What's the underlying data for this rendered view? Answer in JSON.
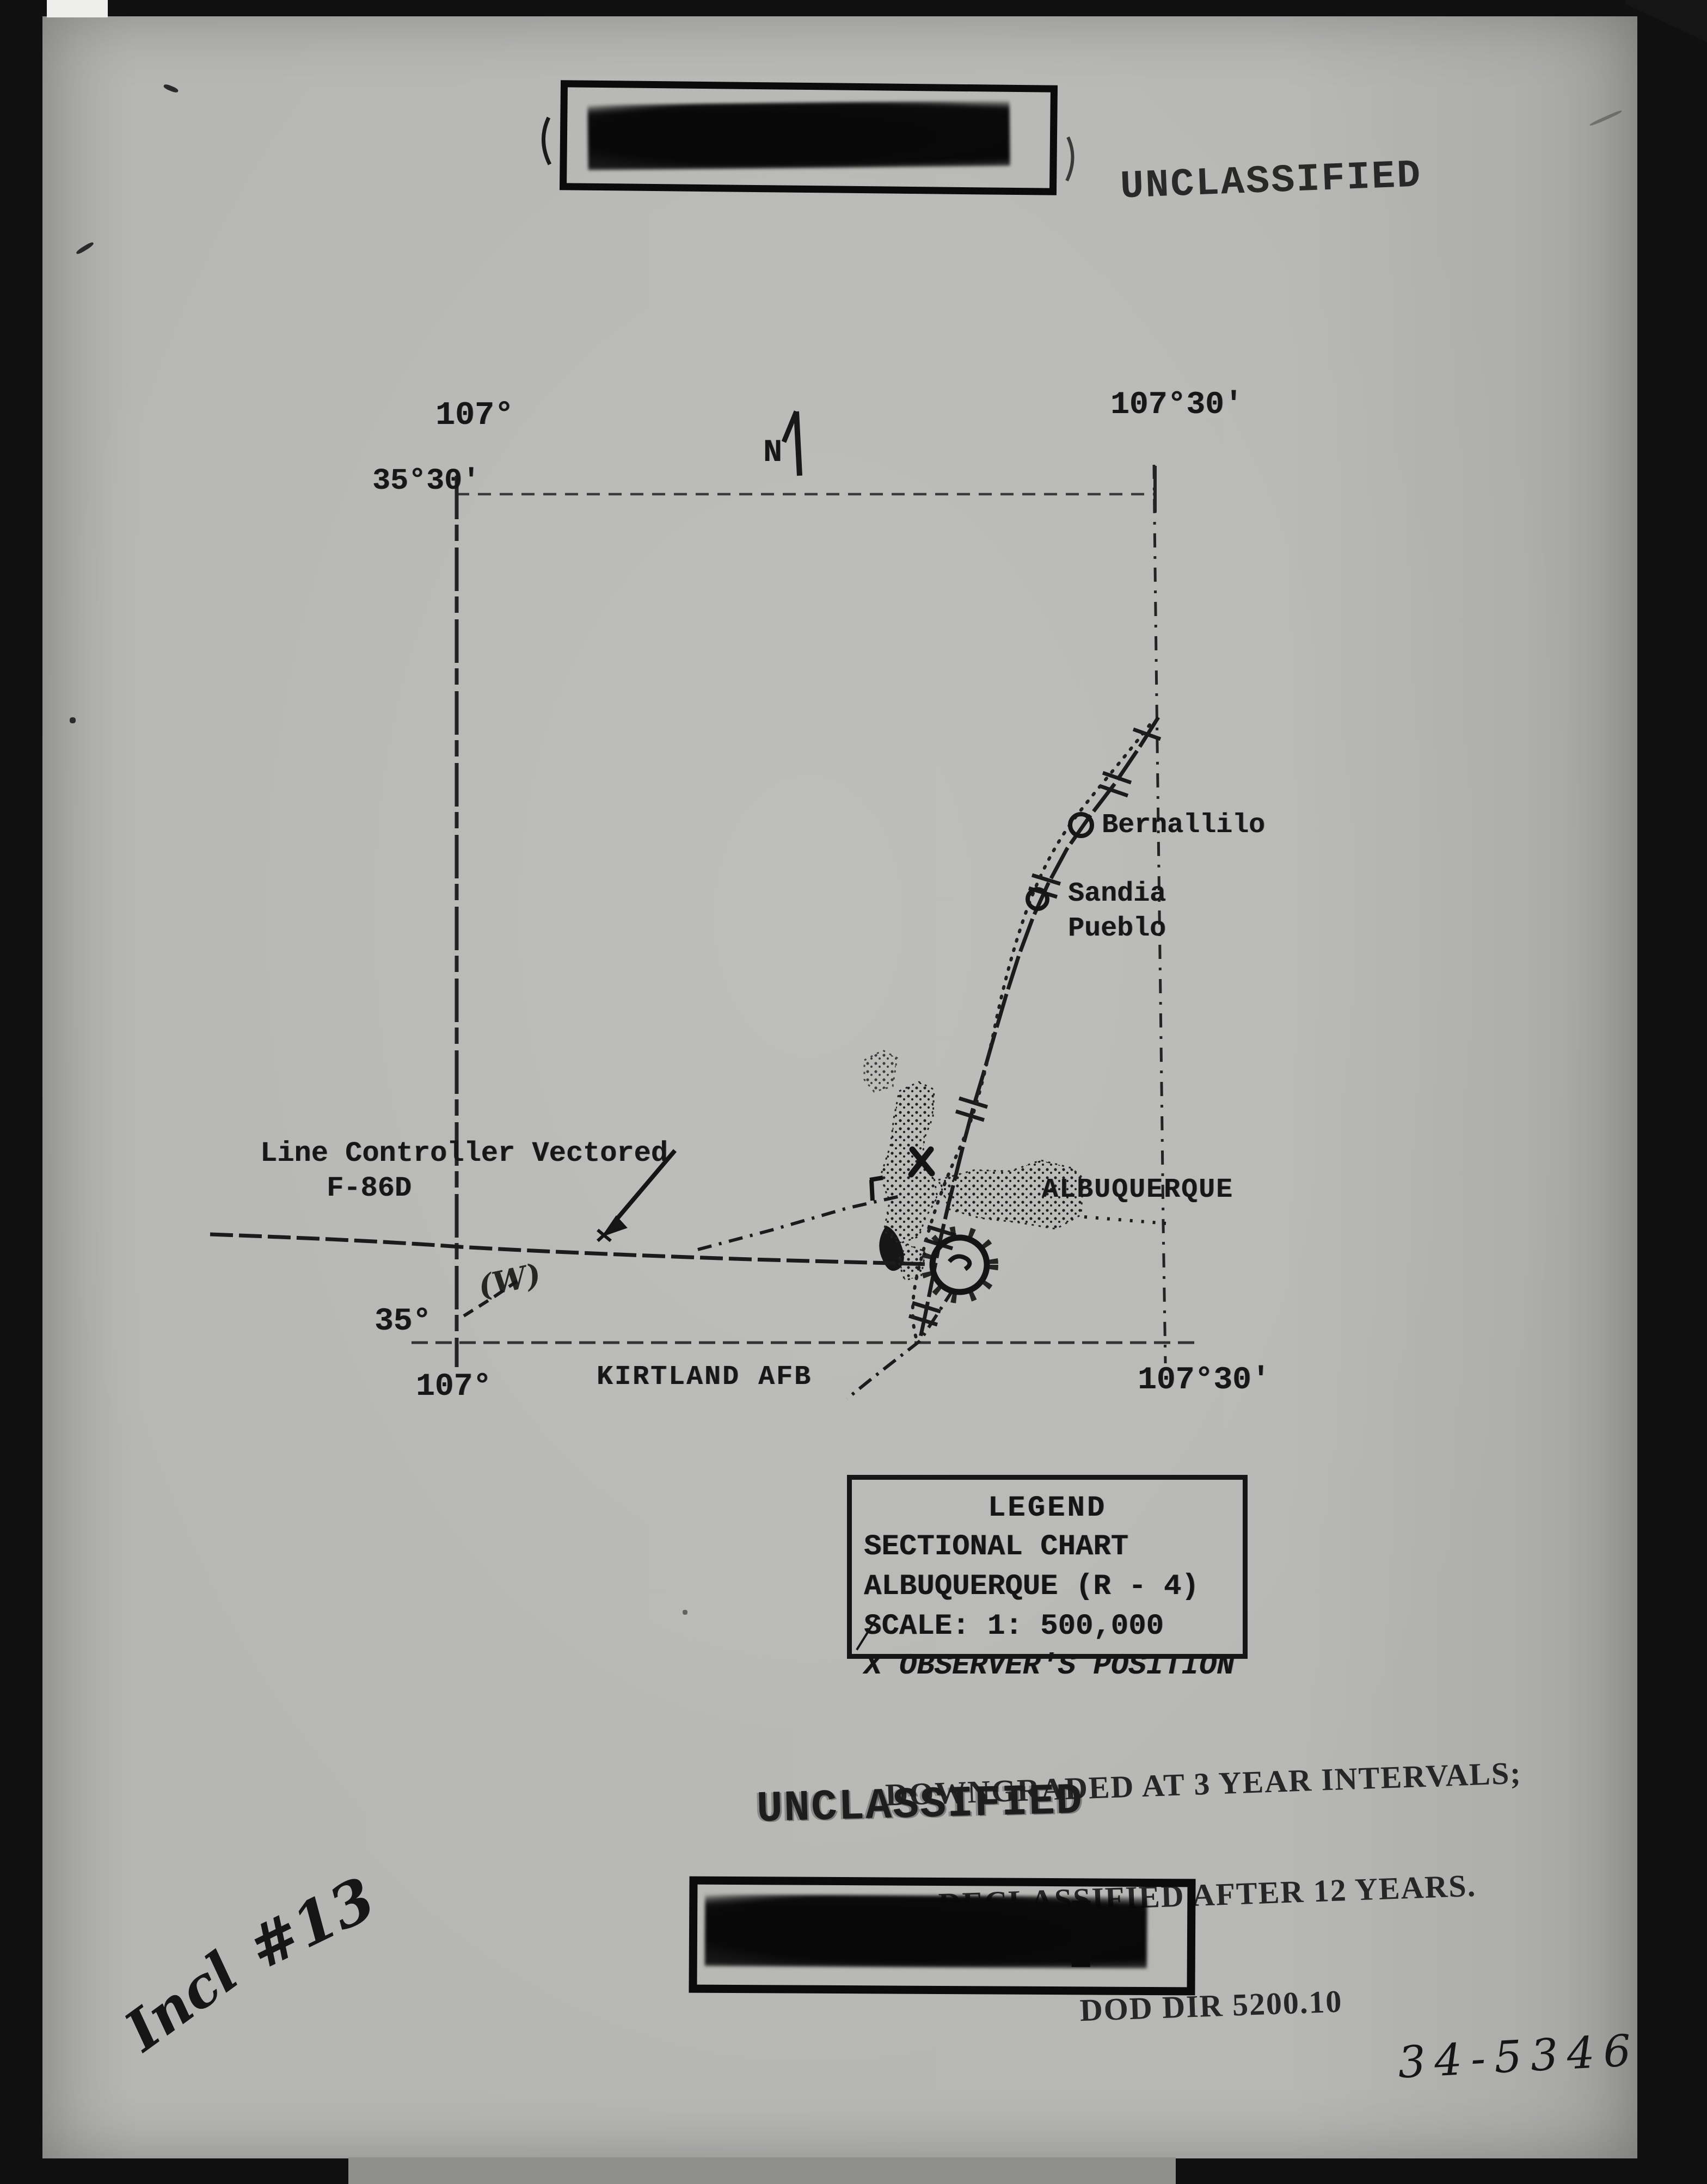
{
  "stamps": {
    "unclassified_top": "UNCLASSIFIED",
    "unclassified_bottom": "UNCLASSIFIED",
    "downgrade_line1": "DOWNGRADED AT 3 YEAR INTERVALS;",
    "downgrade_line2": "DECLASSIFIED AFTER 12 YEARS.",
    "downgrade_line3": "DOD DIR 5200.10"
  },
  "map": {
    "north_label": "N",
    "corners": {
      "top_left_lon": "107°",
      "top_left_lat": "35°30'",
      "top_right_lon": "107°30'",
      "bottom_left_lat": "35°",
      "bottom_left_lon": "107°",
      "bottom_right_lon": "107°30'"
    },
    "places": {
      "bernalillo": "Bernallilo",
      "sandia_line1": "Sandia",
      "sandia_line2": "Pueblo",
      "albuquerque": "ALBUQUERQUE",
      "kirtland": "KIRTLAND AFB"
    },
    "callout_line1": "Line Controller Vectored",
    "callout_line2": "F-86D",
    "annotation_w": "(W)"
  },
  "legend": {
    "title": "LEGEND",
    "line1": "SECTIONAL CHART",
    "line2": "ALBUQUERQUE (R - 4)",
    "line3": "SCALE: 1: 500,000",
    "line4": "X OBSERVER'S POSITION"
  },
  "handwriting": {
    "incl": "Incl",
    "number": "#13",
    "serial": "34-5346"
  },
  "colors": {
    "paper": "#b5b5b3",
    "ink": "#171717",
    "frame": "#101010"
  }
}
